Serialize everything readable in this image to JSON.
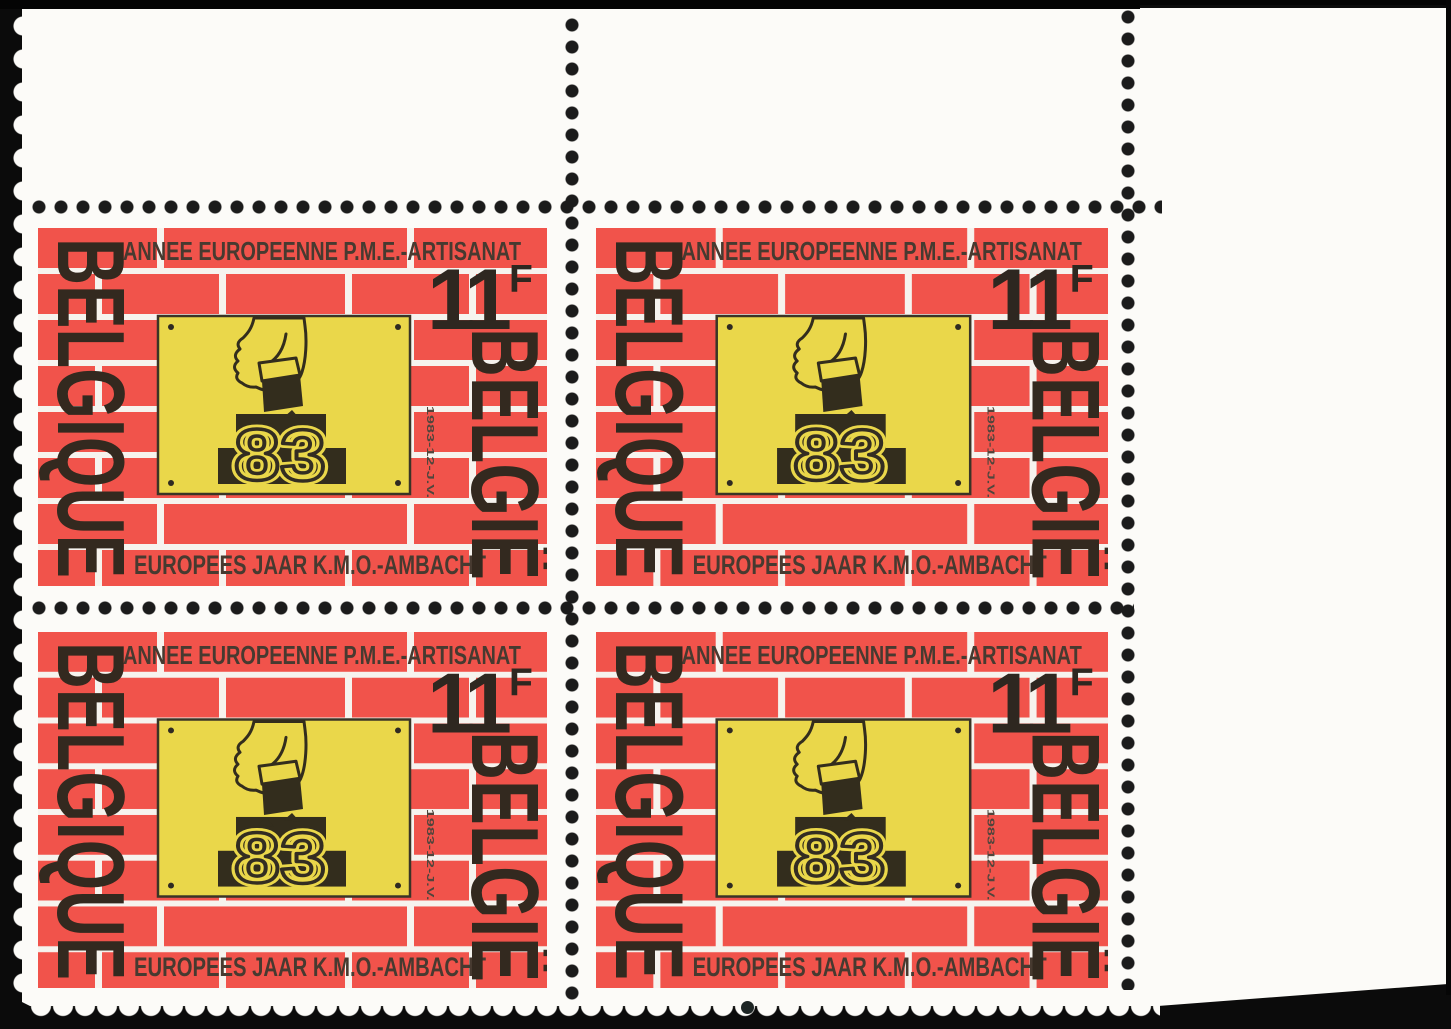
{
  "block": {
    "rows": 2,
    "columns": 2,
    "stamp_count": 4
  },
  "stamp": {
    "top_inscription": "ANNEE EUROPEENNE P.M.E.-ARTISANAT",
    "bottom_inscription": "EUROPEES JAAR K.M.O.-AMBACHT",
    "country_name_french": "BELGIQUE",
    "country_name_dutch": "BELGIË",
    "denomination_value": "11",
    "denomination_unit": "F",
    "central_year": "83",
    "margin_inscription": "1983-12-J.V.",
    "colors": {
      "brick_red": "#f1534b",
      "mortar_white": "#f6f3ee",
      "plaque_yellow": "#ead74a",
      "ink_dark": "#332d22",
      "text_brown": "#473a30",
      "paper_white": "#fcfbf8",
      "scan_background": "#0b0b0b"
    }
  }
}
